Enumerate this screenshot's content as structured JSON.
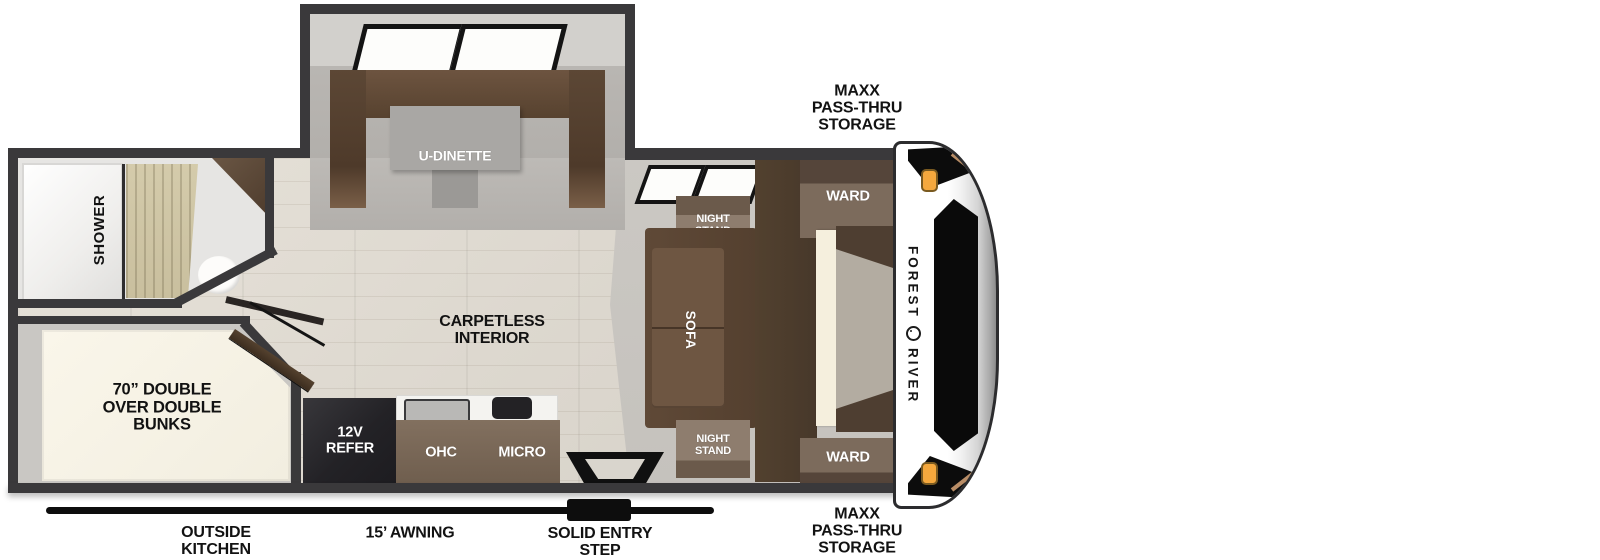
{
  "brand": {
    "word1": "FOREST",
    "word2": "RIVER"
  },
  "exterior": {
    "storage_top": "MAXX\nPASS-THRU\nSTORAGE",
    "storage_bottom": "MAXX\nPASS-THRU\nSTORAGE",
    "outside_kitchen": "OUTSIDE\nKITCHEN",
    "awning": "15’ AWNING",
    "entry_step": "SOLID ENTRY\nSTEP"
  },
  "rooms": {
    "dinette": "U-DINETTE",
    "interior": "CARPETLESS\nINTERIOR",
    "bunks": "70” DOUBLE\nOVER DOUBLE\nBUNKS",
    "shower": "SHOWER",
    "sofa": "SOFA",
    "night_stand_top": "NIGHT\nSTAND",
    "night_stand_bottom": "NIGHT\nSTAND",
    "ward_top": "WARD",
    "ward_bottom": "WARD",
    "refer": "12V\nREFER",
    "ohc": "OHC",
    "micro": "MICRO"
  },
  "colors": {
    "wall": "#3a393b",
    "furniture_brown": "#5d4837",
    "accent_tan": "#b98d66",
    "marker_light": "#f5a83d",
    "bed_cream": "#f6f2e6"
  }
}
